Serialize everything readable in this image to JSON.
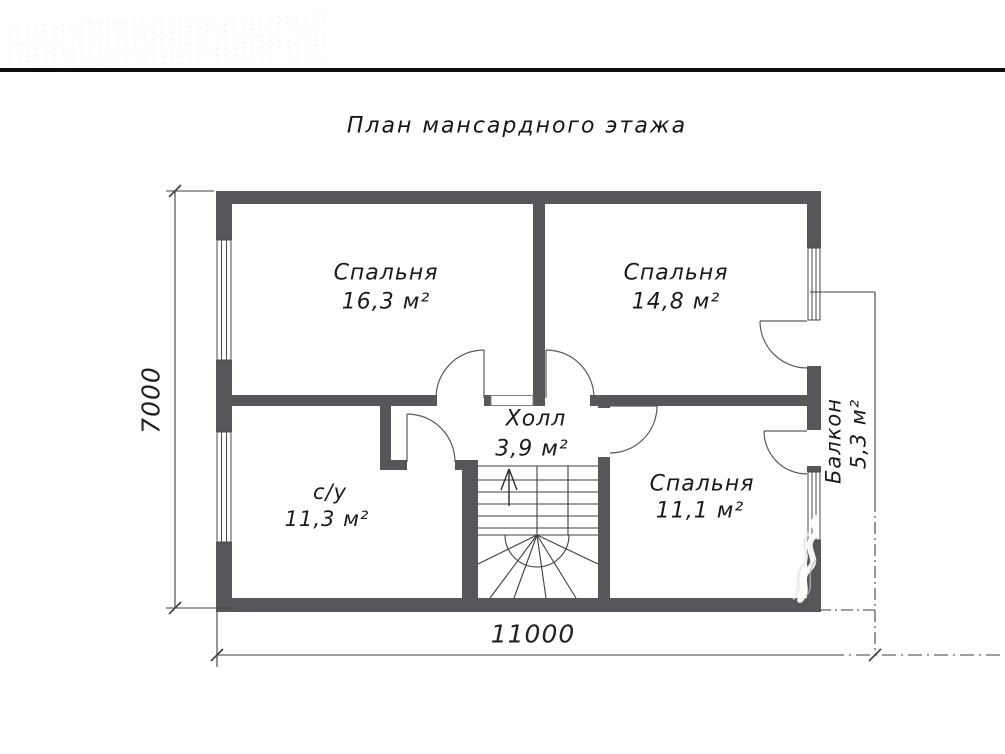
{
  "drawing": {
    "title": "План мансардного этажа",
    "rooms": [
      {
        "id": "bedroom-16",
        "name": "Спальня",
        "area": "16,3 м²"
      },
      {
        "id": "bedroom-14",
        "name": "Спальня",
        "area": "14,8 м²"
      },
      {
        "id": "hall",
        "name": "Холл",
        "area": "3,9 м²"
      },
      {
        "id": "bathroom",
        "name": "с/у",
        "area": "11,3 м²"
      },
      {
        "id": "bedroom-11",
        "name": "Спальня",
        "area": "11,1 м²"
      },
      {
        "id": "balcony",
        "name": "Балкон",
        "area": "5,3 м²"
      }
    ],
    "dimensions": {
      "bottom": "11000",
      "left": "7000"
    },
    "colors": {
      "wall": "#56575a",
      "thin_line": "#3f3f3f",
      "door_arc": "#5a5a5a",
      "text": "#1b1b1b",
      "top_rule": "#0d0d0d"
    }
  }
}
